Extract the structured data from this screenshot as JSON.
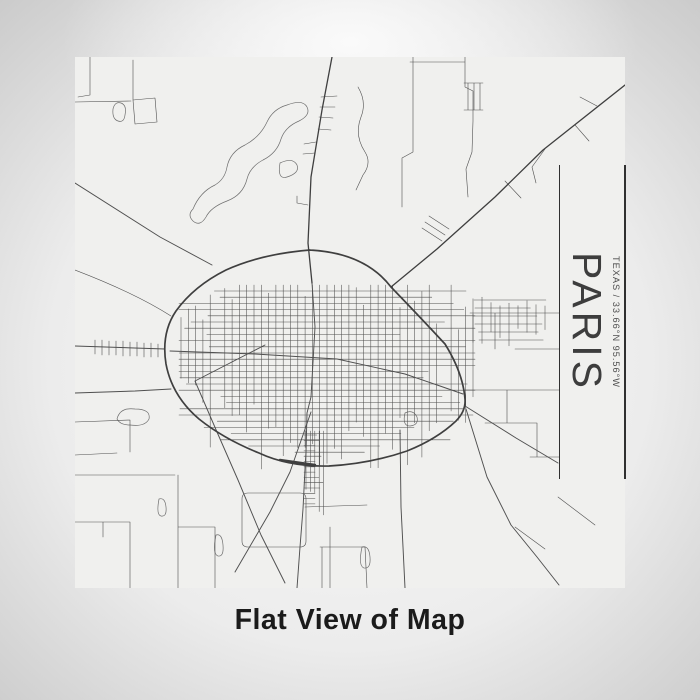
{
  "page": {
    "background": {
      "center": "#fafafa",
      "mid": "#ececec",
      "edge": "#c7c7c7"
    }
  },
  "map_print": {
    "bg_color": "#f0f0ee",
    "road_color": "#4f4f4f",
    "road_color_major": "#3f3f3f",
    "water_outline_color": "#6e6e6e",
    "title_block": {
      "city": "PARIS",
      "coordinates": "TEXAS / 33.66°N 95.56°W",
      "city_color": "#3d3d3d",
      "coordinates_color": "#4f4f4f",
      "rule_color": "#303030"
    }
  },
  "caption": {
    "text": "Flat View of Map",
    "color": "#1b1b1b"
  }
}
